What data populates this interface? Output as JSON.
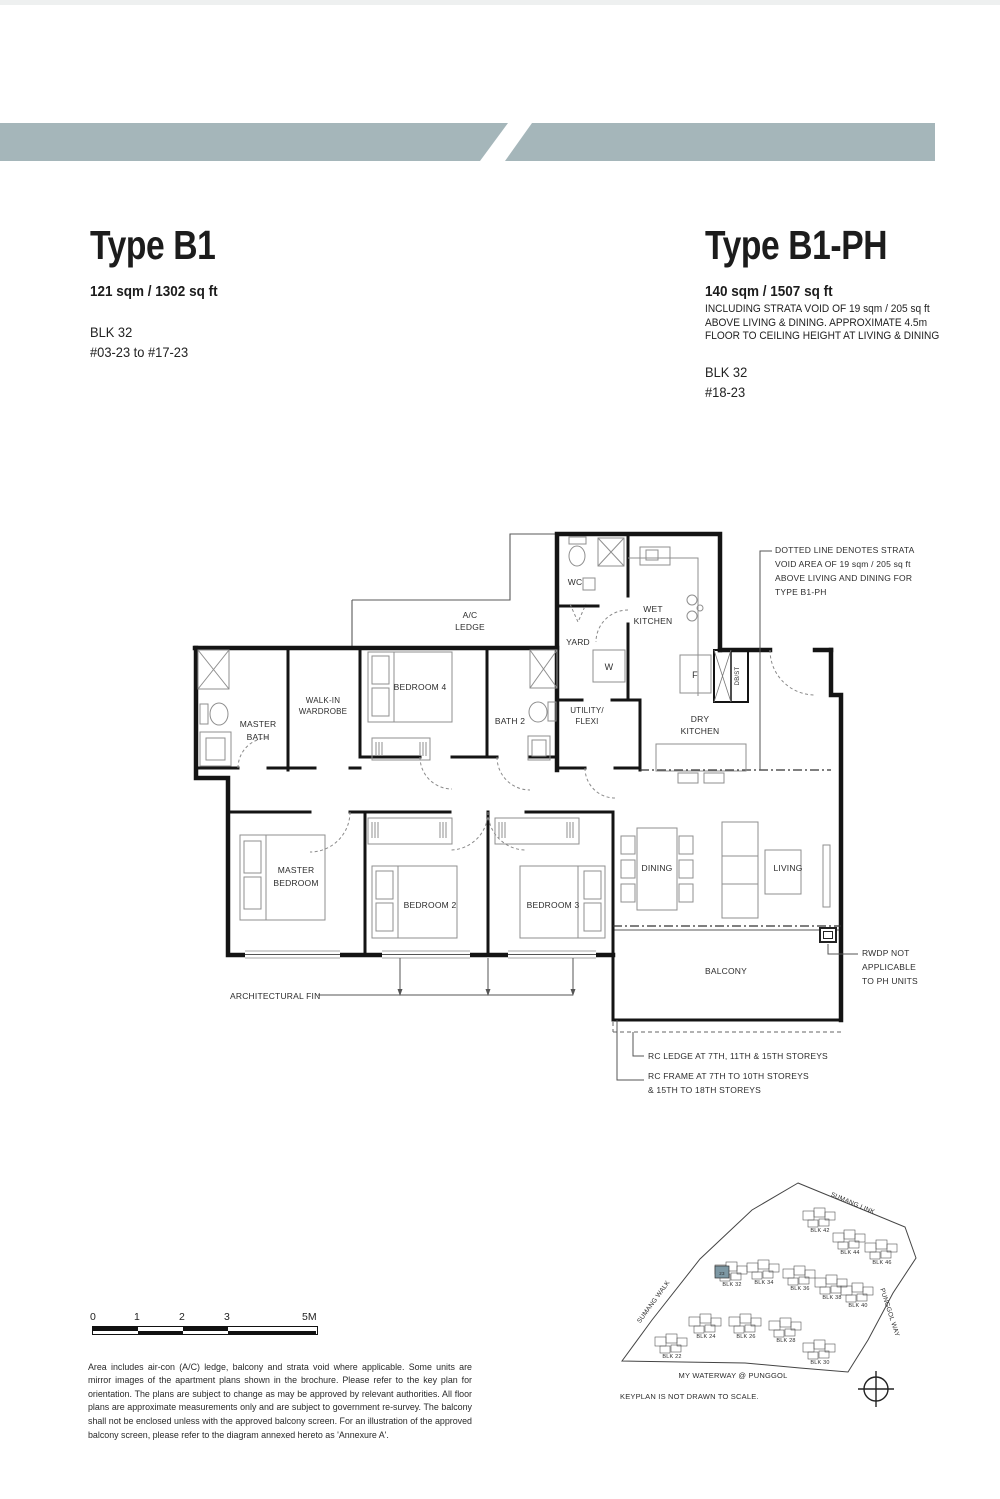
{
  "banners": {
    "color": "#a5b6ba",
    "left": {
      "label": "4-BEDROOM PREMIUM"
    },
    "right": {
      "label": "4-BEDROOM PREMIUM PENTHOUSE"
    }
  },
  "b1": {
    "title": "Type B1",
    "area": "121 sqm / 1302 sq ft",
    "block": "BLK 32",
    "floors": "#03-23 to #17-23"
  },
  "b1ph": {
    "title": "Type B1-PH",
    "area": "140 sqm / 1507 sq ft",
    "note1": "INCLUDING STRATA VOID OF 19 sqm / 205 sq ft",
    "note2": "ABOVE LIVING & DINING. APPROXIMATE 4.5m",
    "note3": "FLOOR TO CEILING HEIGHT AT LIVING & DINING",
    "block": "BLK 32",
    "floors": "#18-23"
  },
  "floorplan": {
    "labels": [
      {
        "x": 470,
        "y": 618,
        "t": "A/C"
      },
      {
        "x": 470,
        "y": 630,
        "t": "LEDGE"
      },
      {
        "x": 575,
        "y": 585,
        "t": "WC"
      },
      {
        "x": 653,
        "y": 612,
        "t": "WET"
      },
      {
        "x": 653,
        "y": 624,
        "t": "KITCHEN"
      },
      {
        "x": 578,
        "y": 645,
        "t": "YARD"
      },
      {
        "x": 609,
        "y": 670,
        "t": "W",
        "s": 9
      },
      {
        "x": 695,
        "y": 678,
        "t": "F",
        "s": 9
      },
      {
        "x": 739,
        "y": 676,
        "t": "DB/ST",
        "s": 6,
        "r": -90
      },
      {
        "x": 258,
        "y": 727,
        "t": "MASTER"
      },
      {
        "x": 258,
        "y": 740,
        "t": "BATH"
      },
      {
        "x": 323,
        "y": 703,
        "t": "WALK-IN",
        "s": 8
      },
      {
        "x": 323,
        "y": 714,
        "t": "WARDROBE",
        "s": 8
      },
      {
        "x": 420,
        "y": 690,
        "t": "BEDROOM 4"
      },
      {
        "x": 510,
        "y": 724,
        "t": "BATH 2"
      },
      {
        "x": 587,
        "y": 713,
        "t": "UTILITY/",
        "s": 8
      },
      {
        "x": 587,
        "y": 724,
        "t": "FLEXI",
        "s": 8
      },
      {
        "x": 700,
        "y": 722,
        "t": "DRY"
      },
      {
        "x": 700,
        "y": 734,
        "t": "KITCHEN"
      },
      {
        "x": 296,
        "y": 873,
        "t": "MASTER"
      },
      {
        "x": 296,
        "y": 886,
        "t": "BEDROOM"
      },
      {
        "x": 430,
        "y": 908,
        "t": "BEDROOM 2"
      },
      {
        "x": 553,
        "y": 908,
        "t": "BEDROOM 3"
      },
      {
        "x": 657,
        "y": 871,
        "t": "DINING"
      },
      {
        "x": 788,
        "y": 871,
        "t": "LIVING"
      },
      {
        "x": 726,
        "y": 974,
        "t": "BALCONY"
      },
      {
        "x": 775,
        "y": 553,
        "t": "DOTTED LINE DENOTES STRATA",
        "a": "start"
      },
      {
        "x": 775,
        "y": 567,
        "t": "VOID AREA OF 19 sqm / 205 sq ft",
        "a": "start"
      },
      {
        "x": 775,
        "y": 581,
        "t": "ABOVE LIVING AND DINING FOR",
        "a": "start"
      },
      {
        "x": 775,
        "y": 595,
        "t": "TYPE B1-PH",
        "a": "start"
      },
      {
        "x": 230,
        "y": 999,
        "t": "ARCHITECTURAL FIN",
        "a": "start"
      },
      {
        "x": 862,
        "y": 956,
        "t": "RWDP NOT",
        "a": "start"
      },
      {
        "x": 862,
        "y": 970,
        "t": "APPLICABLE",
        "a": "start"
      },
      {
        "x": 862,
        "y": 984,
        "t": "TO PH UNITS",
        "a": "start"
      },
      {
        "x": 648,
        "y": 1059,
        "t": "RC LEDGE AT 7TH, 11TH & 15TH STOREYS",
        "a": "start"
      },
      {
        "x": 648,
        "y": 1079,
        "t": "RC FRAME AT 7TH TO 10TH STOREYS",
        "a": "start"
      },
      {
        "x": 648,
        "y": 1093,
        "t": "& 15TH TO 18TH STOREYS",
        "a": "start"
      }
    ]
  },
  "scalebar": {
    "labels": [
      "0",
      "1",
      "2",
      "3",
      "5M"
    ]
  },
  "disclaimer": {
    "text": "Area includes air-con (A/C) ledge, balcony and strata void where applicable. Some units are mirror images of the apartment plans shown in the brochure. Please refer to the key plan for orientation. The plans are subject to change as may be approved by relevant authorities. All floor plans are approximate measurements only and are subject to government re-survey. The balcony shall not be enclosed unless with the approved balcony screen. For an illustration of the approved balcony screen, please refer to the diagram annexed hereto as 'Annexure A'."
  },
  "keyplan": {
    "note": {
      "x": 620,
      "y": 1399,
      "t": "KEYPLAN IS NOT DRAWN TO SCALE.",
      "a": "start",
      "s": 7.5
    },
    "project": {
      "x": 733,
      "y": 1378,
      "t": "MY WATERWAY @ PUNGGOL",
      "s": 7.5,
      "ls": "1.2"
    },
    "roads": [
      {
        "x": 852,
        "y": 1205,
        "t": "SUMANG LINK",
        "r": 23,
        "s": 6.5,
        "ls": "1"
      },
      {
        "x": 655,
        "y": 1303,
        "t": "SUMANG WALK",
        "r": -54,
        "s": 6.5,
        "ls": "1"
      },
      {
        "x": 888,
        "y": 1313,
        "t": "PUNGGOL WAY",
        "r": 72,
        "s": 6.5,
        "ls": "1"
      }
    ],
    "blocks": [
      {
        "x": 672,
        "y": 1358,
        "label": "BLK 22"
      },
      {
        "x": 706,
        "y": 1338,
        "label": "BLK 24"
      },
      {
        "x": 746,
        "y": 1338,
        "label": "BLK 26"
      },
      {
        "x": 786,
        "y": 1342,
        "label": "BLK 28"
      },
      {
        "x": 820,
        "y": 1364,
        "label": "BLK 30"
      },
      {
        "x": 732,
        "y": 1286,
        "label": "BLK 32"
      },
      {
        "x": 764,
        "y": 1284,
        "label": "BLK 34"
      },
      {
        "x": 800,
        "y": 1290,
        "label": "BLK 36"
      },
      {
        "x": 832,
        "y": 1299,
        "label": "BLK 38"
      },
      {
        "x": 858,
        "y": 1307,
        "label": "BLK 40"
      },
      {
        "x": 820,
        "y": 1232,
        "label": "BLK 42"
      },
      {
        "x": 850,
        "y": 1254,
        "label": "BLK 44"
      },
      {
        "x": 882,
        "y": 1264,
        "label": "BLK 46"
      }
    ],
    "highlight": {
      "x": 715,
      "y": 1266,
      "w": 14,
      "h": 12,
      "label": "23",
      "color": "#7d98a4"
    }
  }
}
